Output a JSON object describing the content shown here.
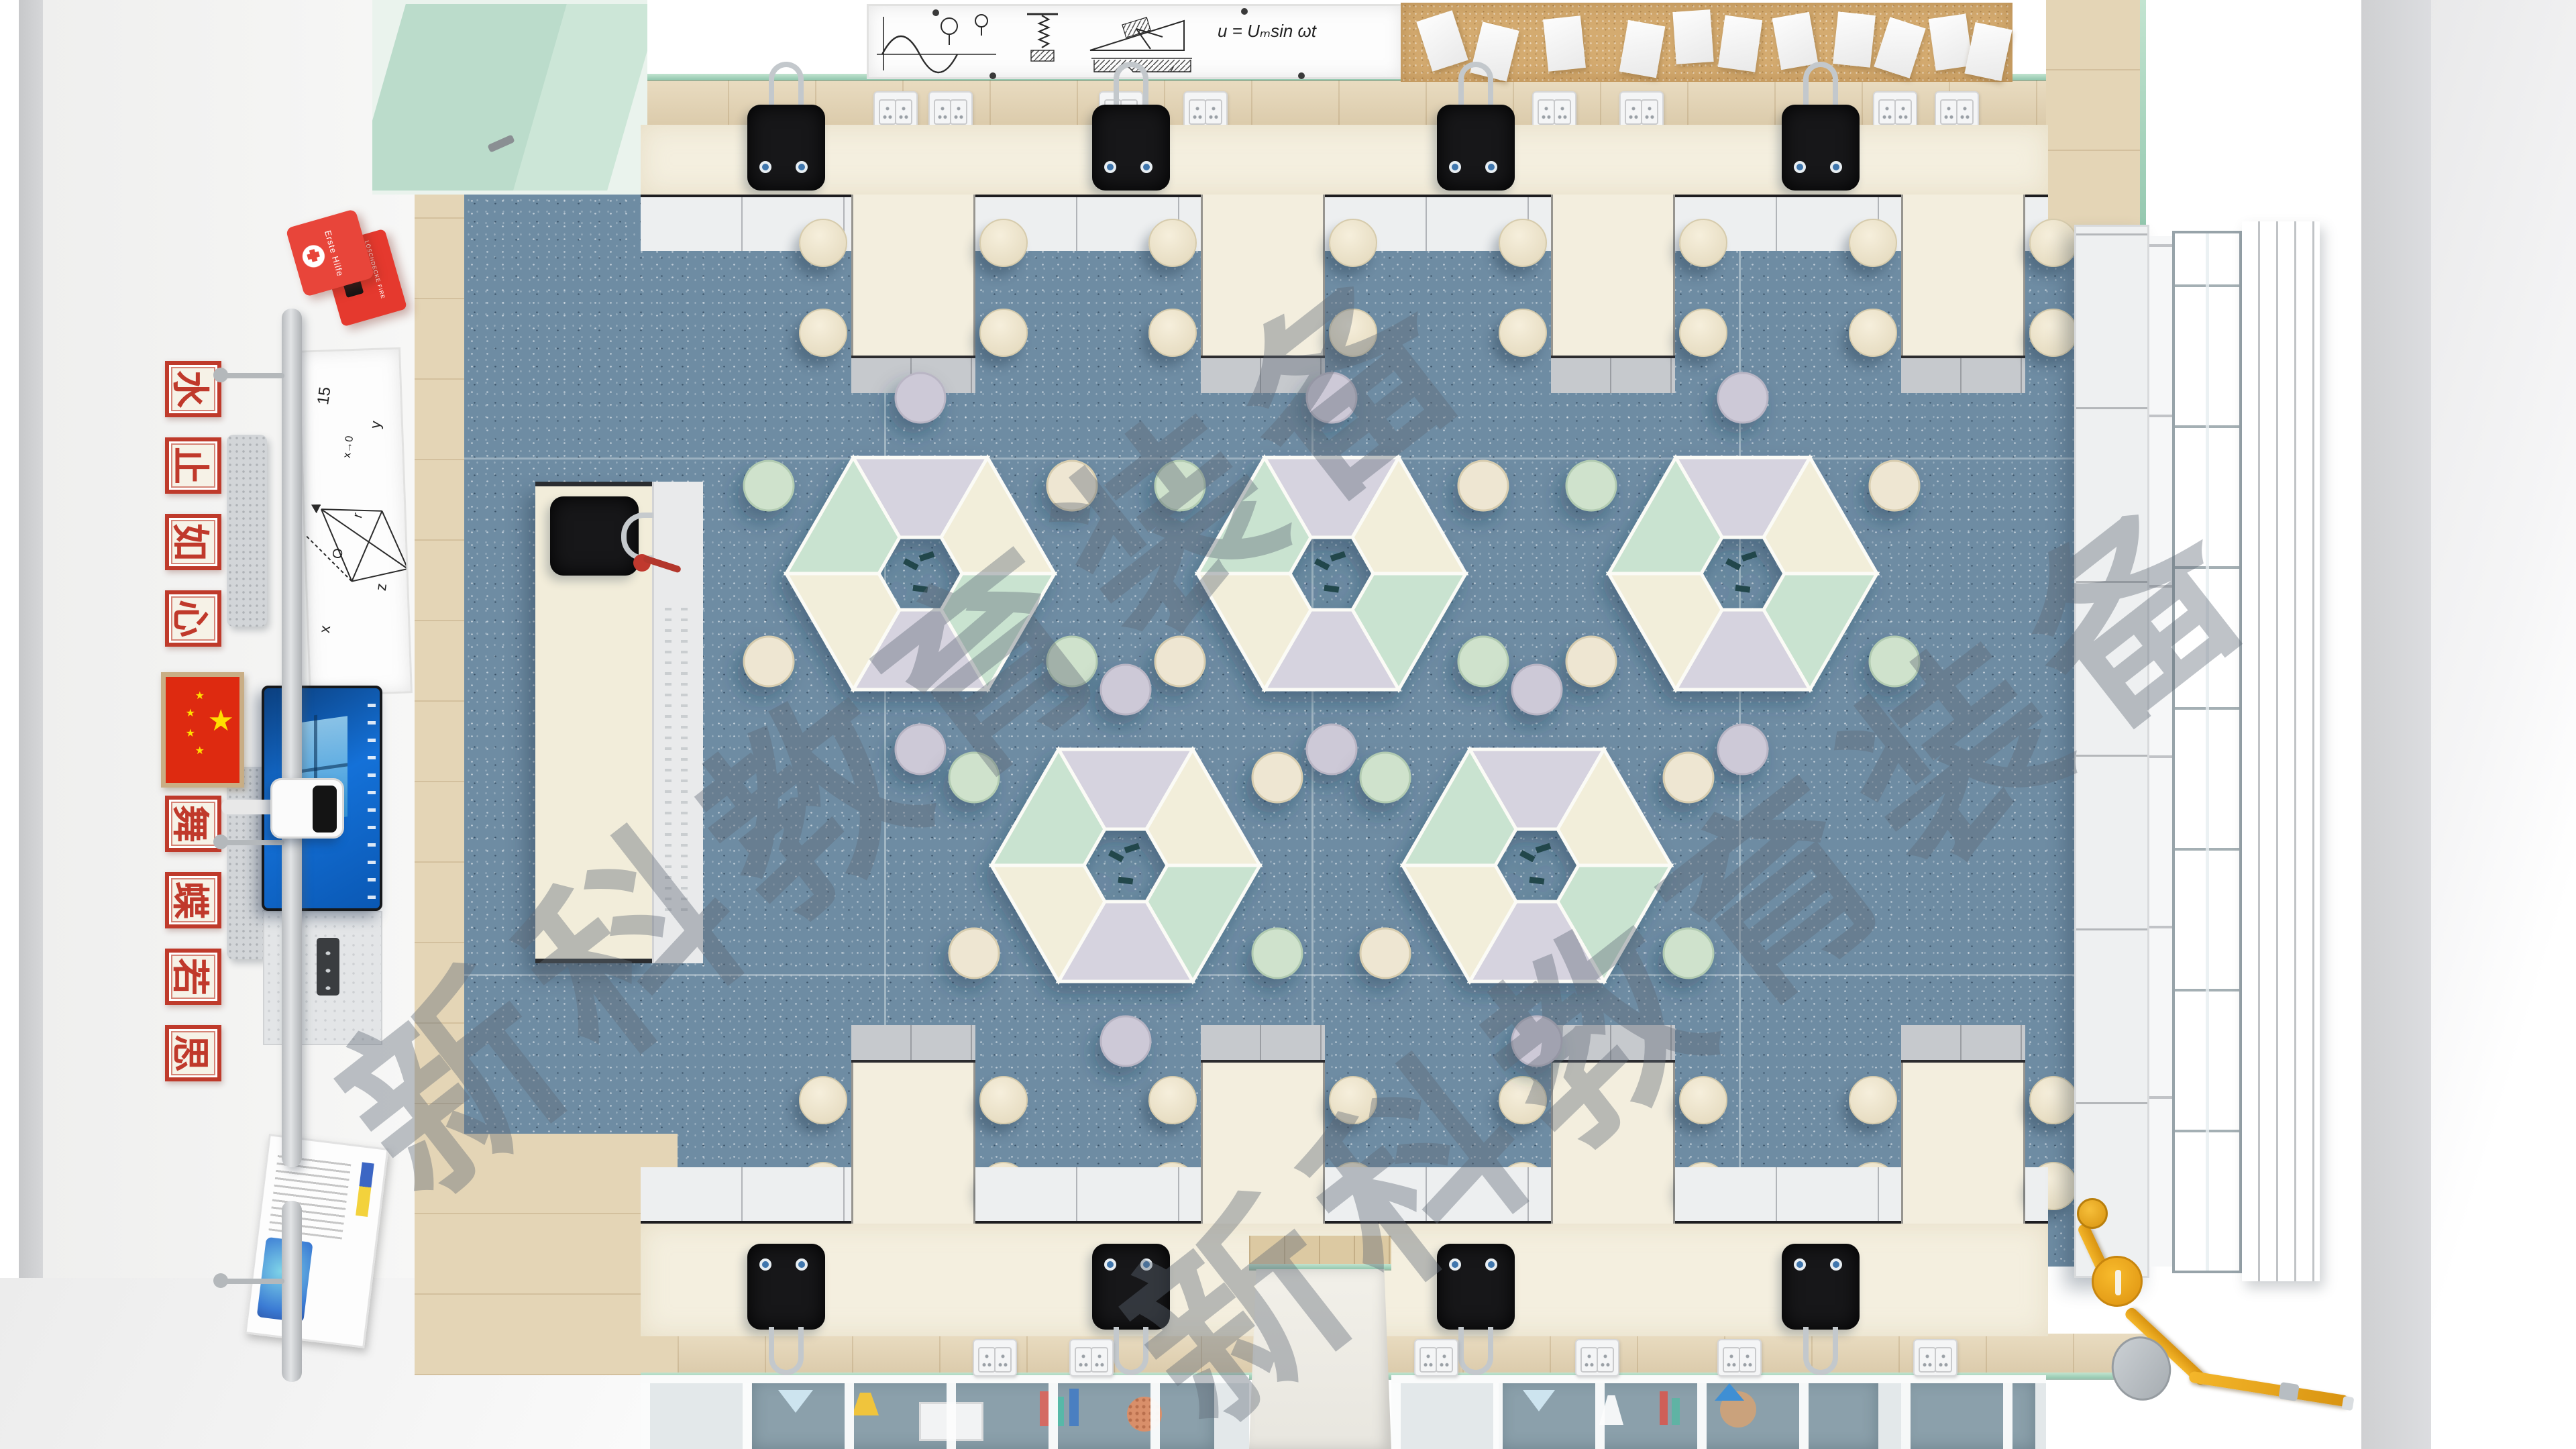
{
  "scene": {
    "title": "Science classroom top-down 3D render"
  },
  "watermark": {
    "text": "新科教育装备"
  },
  "left_wall": {
    "first_aid_label": "Erste Hilfe",
    "fire_blanket_label": "LÖSCHDECKE FIRE BLANKET",
    "signs_top": [
      "水",
      "止",
      "如",
      "心"
    ],
    "signs_bottom": [
      "舞",
      "蝶",
      "若",
      "思"
    ],
    "math_board": {
      "value_15": "15",
      "limit": "x→0",
      "axis_x": "x",
      "axis_y": "y",
      "axis_z": "z",
      "origin": "O",
      "vector": "r"
    }
  },
  "top_wall": {
    "formula": "u = Uₘsin ωt"
  },
  "flag": {
    "star": "★"
  },
  "palette": {
    "carpet_blue": "#6E8CA3",
    "bench_cream": "#F3EEDE",
    "mint": "#C9E3D0",
    "lavender": "#D6D3DF",
    "wood": "#E6D7B8",
    "glass_green": "#A8D8C0",
    "sink_black": "#171719",
    "cabinet_white": "#EEF0F1",
    "cap_gray": "#C8CBCF",
    "pipe_yellow": "#E8A81C",
    "fire_red": "#E8453A",
    "screen_blue": "#1471D8",
    "cork_tan": "#D4AB70",
    "poster_slate": "#8BA0AB"
  },
  "counts": {
    "hex_tables": 5,
    "stools_per_hex": 6,
    "wall_sinks": 8,
    "teacher_sink": 1,
    "peninsula_benches": 8,
    "cork_papers": 11
  }
}
